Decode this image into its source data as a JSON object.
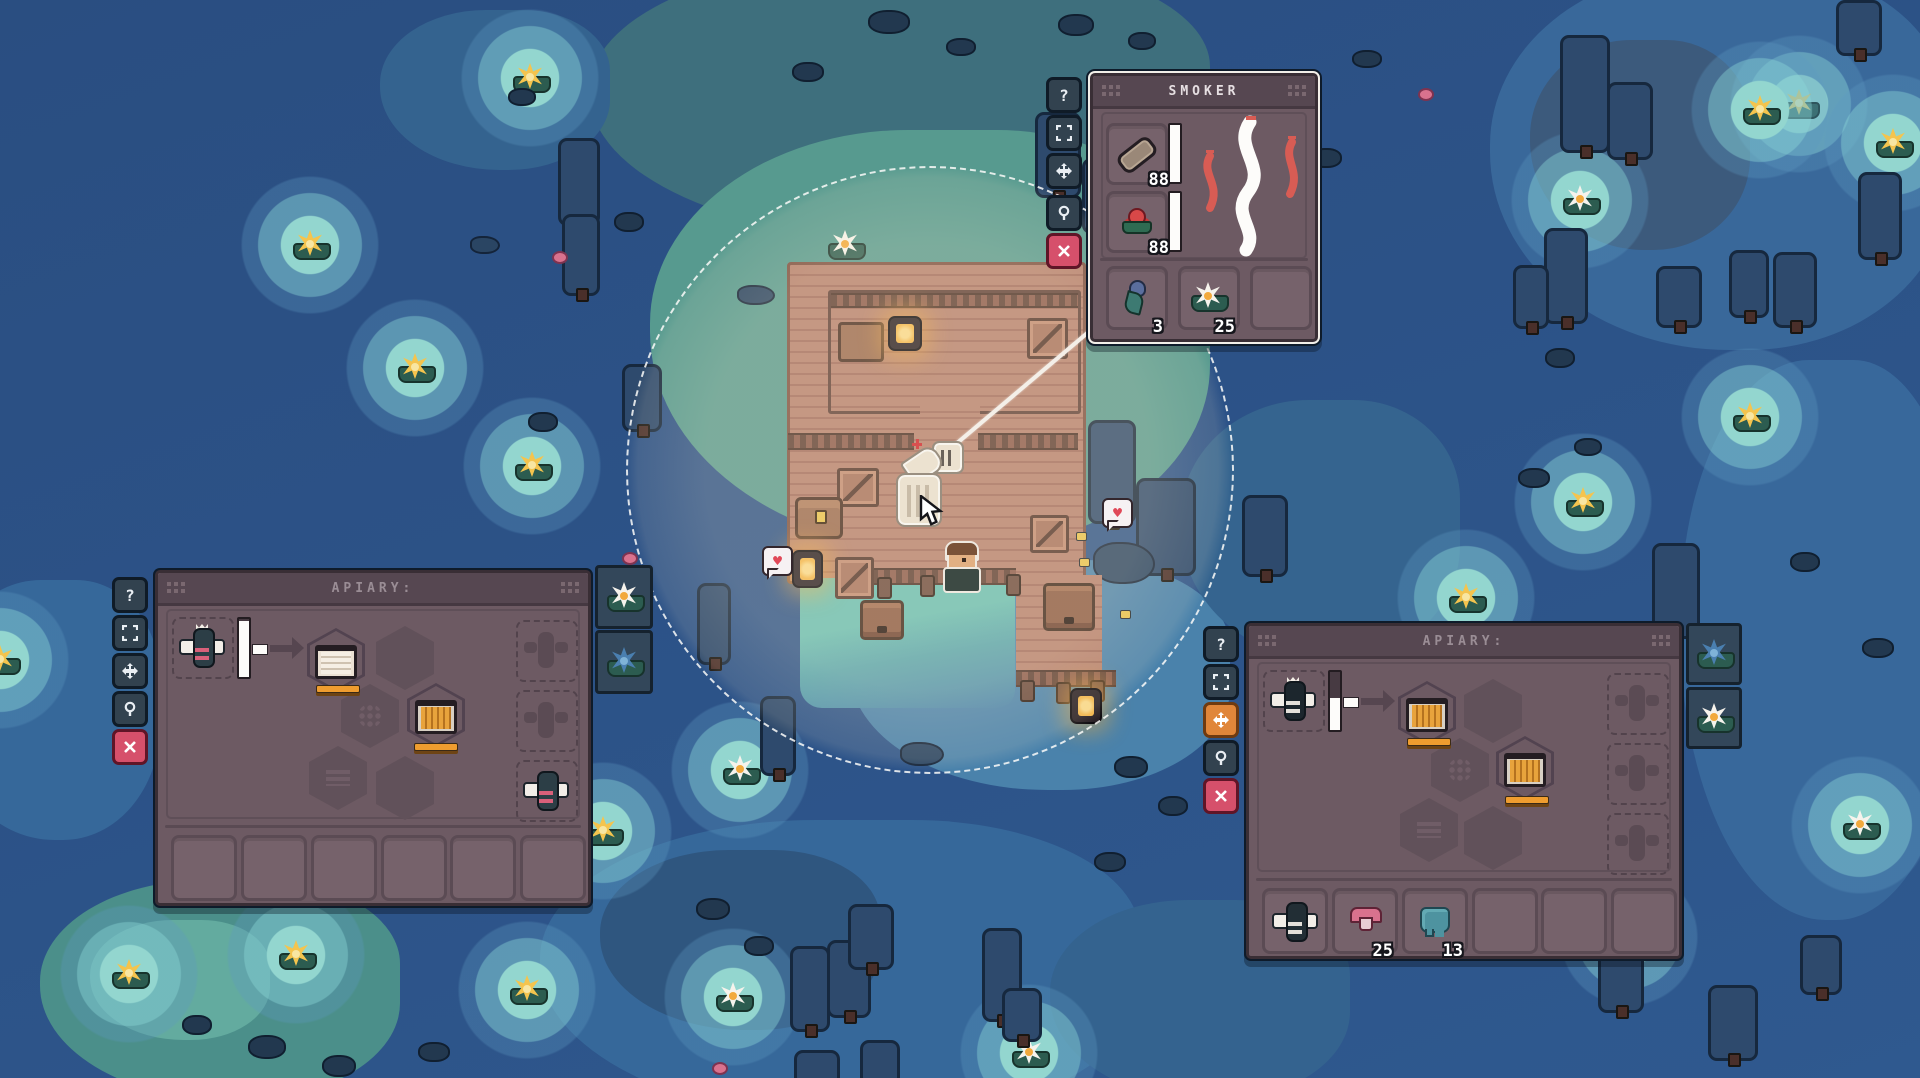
{
  "panels": {
    "smoker": {
      "title": "SMOKER",
      "inputs": [
        {
          "item": "log",
          "count": "88"
        },
        {
          "item": "red-flower",
          "count": "88"
        }
      ],
      "outputs": [
        {
          "item": "blue-flower",
          "count": "3"
        },
        {
          "item": "water-lily",
          "count": "25"
        },
        {
          "item": "empty",
          "count": ""
        }
      ]
    },
    "apiary_left": {
      "title": "APIARY:",
      "queen_slot": "queen-bee",
      "frame_slots": [
        "uncapped-frame",
        "honey-frame"
      ],
      "bee_slots": [
        "ghost-bee",
        "ghost-bee",
        "worker-bee"
      ],
      "storage": [
        {
          "item": "empty",
          "count": ""
        },
        {
          "item": "empty",
          "count": ""
        },
        {
          "item": "empty",
          "count": ""
        },
        {
          "item": "empty",
          "count": ""
        },
        {
          "item": "empty",
          "count": ""
        },
        {
          "item": "empty",
          "count": ""
        }
      ]
    },
    "apiary_right": {
      "title": "APIARY:",
      "queen_slot": "queen-bee",
      "frame_slots": [
        "honey-frame",
        "honey-frame"
      ],
      "bee_slots": [
        "ghost-bee",
        "ghost-bee",
        "ghost-bee"
      ],
      "storage": [
        {
          "item": "drone-bee",
          "count": ""
        },
        {
          "item": "pink-mushroom",
          "count": "25"
        },
        {
          "item": "teal-droplet",
          "count": "13"
        },
        {
          "item": "empty",
          "count": ""
        },
        {
          "item": "empty",
          "count": ""
        },
        {
          "item": "empty",
          "count": ""
        }
      ]
    }
  },
  "ui": {
    "help_glyph": "?",
    "side_buttons": [
      "help",
      "resize",
      "move",
      "inspect",
      "close"
    ],
    "cursor": "arrow-pointer",
    "drag_item": "smoker",
    "colors": {
      "accent_orange": "#ef9d2f",
      "panel_bg": "#6d5a63",
      "water": "#2c5287",
      "glow_teal": "#8ed2cc",
      "close_pink": "#d6506b",
      "move_highlight": "#e0863a",
      "deck_wood": "#b5806e"
    }
  },
  "map": {
    "left_flower_tiles": [
      "white-water-lily",
      "blue-water-lily"
    ],
    "right_flower_tiles": [
      "blue-water-lily",
      "white-water-lily"
    ]
  }
}
